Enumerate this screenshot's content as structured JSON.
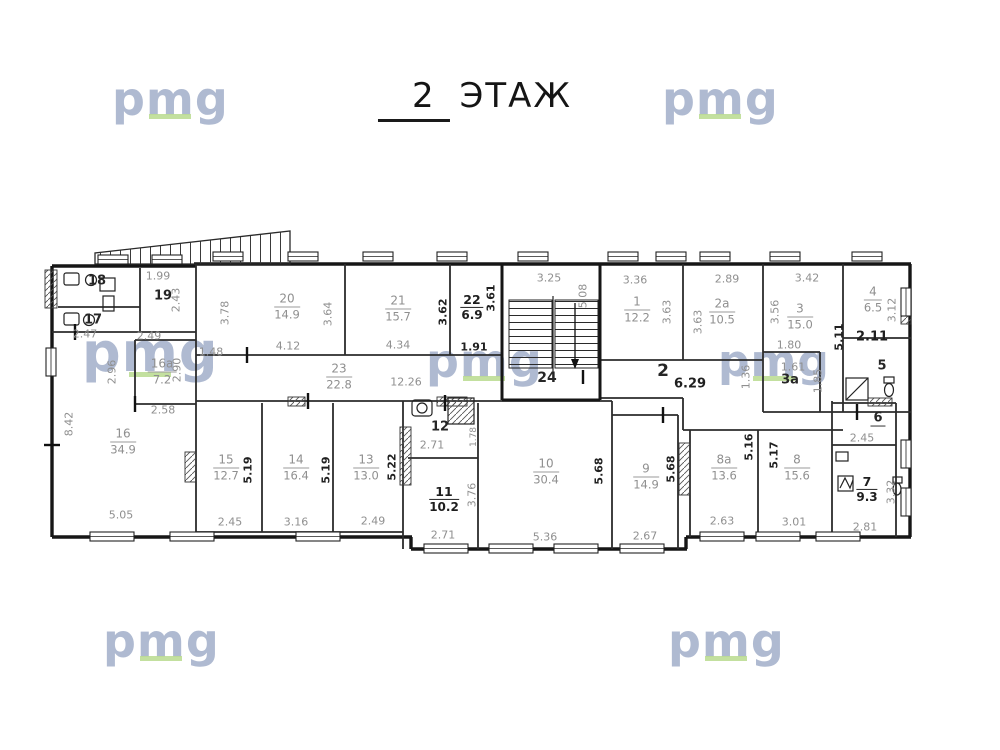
{
  "title": {
    "number": "2",
    "label": "ЭТАЖ"
  },
  "watermark": {
    "text": "pmg",
    "color": "#a9b5ce",
    "underline_color": "#b7d98b"
  },
  "icons": [
    "stairs-icon",
    "fire-escape-stairs-icon",
    "toilet-icon",
    "sink-icon",
    "shower-icon",
    "window-icon"
  ],
  "plan": {
    "floor": "2",
    "labels": [
      {
        "n": "room-20-label",
        "k": "room",
        "num": "20",
        "area": "14.9",
        "x": 287,
        "y": 307
      },
      {
        "n": "room-21-label",
        "k": "room",
        "num": "21",
        "area": "15.7",
        "x": 398,
        "y": 309
      },
      {
        "n": "room-22-label",
        "k": "room-dark",
        "num": "22",
        "area": "6.9",
        "x": 472,
        "y": 308
      },
      {
        "n": "room-1-label",
        "k": "room",
        "num": "1",
        "area": "12.2",
        "x": 637,
        "y": 310
      },
      {
        "n": "room-2a-label",
        "k": "room",
        "num": "2a",
        "area": "10.5",
        "x": 722,
        "y": 312
      },
      {
        "n": "room-3-label",
        "k": "room",
        "num": "3",
        "area": "15.0",
        "x": 800,
        "y": 317
      },
      {
        "n": "room-4-label",
        "k": "room",
        "num": "4",
        "area": "6.5",
        "x": 873,
        "y": 300
      },
      {
        "n": "room-23-label",
        "k": "room",
        "num": "23",
        "area": "22.8",
        "x": 339,
        "y": 377,
        "fs": 10
      },
      {
        "n": "room-16a-label",
        "k": "room",
        "num": "16a",
        "area": "7.2",
        "x": 162,
        "y": 372,
        "fs": 10
      },
      {
        "n": "room-16-label",
        "k": "room",
        "num": "16",
        "area": "34.9",
        "x": 123,
        "y": 442
      },
      {
        "n": "room-15-label",
        "k": "room",
        "num": "15",
        "area": "12.7",
        "x": 226,
        "y": 468
      },
      {
        "n": "room-14-label",
        "k": "room",
        "num": "14",
        "area": "16.4",
        "x": 296,
        "y": 468
      },
      {
        "n": "room-13-label",
        "k": "room",
        "num": "13",
        "area": "13.0",
        "x": 366,
        "y": 468
      },
      {
        "n": "room-11-label",
        "k": "room-dark",
        "num": "11",
        "area": "10.2",
        "x": 444,
        "y": 500
      },
      {
        "n": "room-10-label",
        "k": "room",
        "num": "10",
        "area": "30.4",
        "x": 546,
        "y": 472
      },
      {
        "n": "room-9-label",
        "k": "room",
        "num": "9",
        "area": "14.9",
        "x": 646,
        "y": 477
      },
      {
        "n": "room-8a-label",
        "k": "room",
        "num": "8a",
        "area": "13.6",
        "x": 724,
        "y": 468
      },
      {
        "n": "room-8-label",
        "k": "room",
        "num": "8",
        "area": "15.6",
        "x": 797,
        "y": 468
      },
      {
        "n": "room-7-label",
        "k": "room-dark",
        "num": "7",
        "area": "9.3",
        "x": 867,
        "y": 490
      },
      {
        "n": "room-18-number",
        "k": "num",
        "t": "18",
        "x": 97,
        "y": 282
      },
      {
        "n": "room-17-number",
        "k": "num",
        "t": "17",
        "x": 93,
        "y": 321
      },
      {
        "n": "room-19-number",
        "k": "num",
        "t": "19",
        "x": 163,
        "y": 297
      },
      {
        "n": "room-12-number",
        "k": "num",
        "t": "12",
        "x": 440,
        "y": 428
      },
      {
        "n": "stair-24-number",
        "k": "num",
        "t": "24",
        "x": 547,
        "y": 378,
        "fs": 14
      },
      {
        "n": "room-5-number",
        "k": "num",
        "t": "5",
        "x": 882,
        "y": 367
      },
      {
        "n": "room-3a-number",
        "k": "num",
        "t": "3a",
        "x": 790,
        "y": 381
      },
      {
        "n": "room-6-number",
        "k": "num-ul",
        "t": "6",
        "x": 878,
        "y": 419
      },
      {
        "n": "corridor-2-number",
        "k": "num",
        "t": "2",
        "x": 663,
        "y": 372,
        "fs": 17
      },
      {
        "n": "dim-label",
        "k": "dim",
        "t": "1.99",
        "x": 158,
        "y": 277
      },
      {
        "n": "dim-label",
        "k": "dim",
        "t": "2.43",
        "x": 177,
        "y": 300,
        "r": 1
      },
      {
        "n": "dim-label",
        "k": "dim",
        "t": "2.47",
        "x": 85,
        "y": 335
      },
      {
        "n": "dim-label",
        "k": "dim",
        "t": "2.49",
        "x": 149,
        "y": 337
      },
      {
        "n": "dim-label",
        "k": "dim",
        "t": "2.96",
        "x": 113,
        "y": 372,
        "r": 1
      },
      {
        "n": "dim-label",
        "k": "dim",
        "t": "2.90",
        "x": 178,
        "y": 370,
        "r": 1
      },
      {
        "n": "dim-label",
        "k": "dim",
        "t": "2.58",
        "x": 163,
        "y": 411
      },
      {
        "n": "dim-label",
        "k": "dim",
        "t": "8.42",
        "x": 70,
        "y": 424,
        "r": 1
      },
      {
        "n": "dim-label",
        "k": "dim",
        "t": "5.05",
        "x": 121,
        "y": 516
      },
      {
        "n": "dim-label",
        "k": "dim",
        "t": "1.48",
        "x": 211,
        "y": 353
      },
      {
        "n": "dim-label",
        "k": "dim",
        "t": "3.78",
        "x": 226,
        "y": 313,
        "r": 1
      },
      {
        "n": "dim-label",
        "k": "dim",
        "t": "3.64",
        "x": 329,
        "y": 314,
        "r": 1
      },
      {
        "n": "dim-label",
        "k": "dim",
        "t": "4.12",
        "x": 288,
        "y": 347
      },
      {
        "n": "dim-label",
        "k": "dim-d",
        "t": "3.62",
        "x": 444,
        "y": 312,
        "r": 1
      },
      {
        "n": "dim-label",
        "k": "dim",
        "t": "4.34",
        "x": 398,
        "y": 346
      },
      {
        "n": "dim-label",
        "k": "dim-d",
        "t": "3.61",
        "x": 492,
        "y": 298,
        "r": 1
      },
      {
        "n": "dim-label",
        "k": "dim-d",
        "t": "1.91",
        "x": 474,
        "y": 348
      },
      {
        "n": "dim-label",
        "k": "dim",
        "t": "12.26",
        "x": 406,
        "y": 383
      },
      {
        "n": "dim-label",
        "k": "dim",
        "t": "3.25",
        "x": 549,
        "y": 279
      },
      {
        "n": "dim-label",
        "k": "dim",
        "t": "5.08",
        "x": 584,
        "y": 296,
        "r": 1
      },
      {
        "n": "dim-label",
        "k": "dim",
        "t": "3.36",
        "x": 635,
        "y": 281
      },
      {
        "n": "dim-label",
        "k": "dim",
        "t": "3.63",
        "x": 668,
        "y": 312,
        "r": 1
      },
      {
        "n": "dim-label",
        "k": "dim",
        "t": "2.89",
        "x": 727,
        "y": 280
      },
      {
        "n": "dim-label",
        "k": "dim",
        "t": "3.63",
        "x": 699,
        "y": 322,
        "r": 1
      },
      {
        "n": "dim-label",
        "k": "dim-d",
        "t": "6.29",
        "x": 690,
        "y": 385,
        "fs": 13
      },
      {
        "n": "dim-label",
        "k": "dim",
        "t": "1.36",
        "x": 747,
        "y": 377,
        "r": 1
      },
      {
        "n": "dim-label",
        "k": "dim",
        "t": "3.42",
        "x": 807,
        "y": 279
      },
      {
        "n": "dim-label",
        "k": "dim",
        "t": "3.56",
        "x": 776,
        "y": 312,
        "r": 1
      },
      {
        "n": "dim-label",
        "k": "dim-d",
        "t": "5.11",
        "x": 840,
        "y": 337,
        "r": 1
      },
      {
        "n": "dim-label",
        "k": "dim",
        "t": "3.12",
        "x": 893,
        "y": 310,
        "r": 1
      },
      {
        "n": "dim-label",
        "k": "dim-d",
        "t": "2.11",
        "x": 872,
        "y": 338,
        "fs": 13
      },
      {
        "n": "dim-label",
        "k": "dim",
        "t": "1.80",
        "x": 789,
        "y": 346
      },
      {
        "n": "dim-label",
        "k": "dim",
        "t": "1.61",
        "x": 793,
        "y": 368
      },
      {
        "n": "dim-label",
        "k": "dim",
        "t": "1.85",
        "x": 819,
        "y": 381,
        "r": 1
      },
      {
        "n": "dim-label",
        "k": "dim",
        "t": "2.45",
        "x": 230,
        "y": 523
      },
      {
        "n": "dim-label",
        "k": "dim-d",
        "t": "5.19",
        "x": 249,
        "y": 470,
        "r": 1
      },
      {
        "n": "dim-label",
        "k": "dim",
        "t": "3.16",
        "x": 296,
        "y": 523
      },
      {
        "n": "dim-label",
        "k": "dim-d",
        "t": "5.19",
        "x": 327,
        "y": 470,
        "r": 1
      },
      {
        "n": "dim-label",
        "k": "dim",
        "t": "2.49",
        "x": 373,
        "y": 522
      },
      {
        "n": "dim-label",
        "k": "dim-d",
        "t": "5.22",
        "x": 393,
        "y": 467,
        "r": 1
      },
      {
        "n": "dim-label",
        "k": "dim",
        "t": "2.71",
        "x": 432,
        "y": 446
      },
      {
        "n": "dim-label",
        "k": "dim",
        "t": "1.78",
        "x": 474,
        "y": 437,
        "r": 1,
        "fs": 9
      },
      {
        "n": "dim-label",
        "k": "dim",
        "t": "3.76",
        "x": 473,
        "y": 495,
        "r": 1
      },
      {
        "n": "dim-label",
        "k": "dim",
        "t": "2.71",
        "x": 443,
        "y": 536
      },
      {
        "n": "dim-label",
        "k": "dim",
        "t": "5.36",
        "x": 545,
        "y": 538
      },
      {
        "n": "dim-label",
        "k": "dim-d",
        "t": "5.68",
        "x": 600,
        "y": 471,
        "r": 1
      },
      {
        "n": "dim-label",
        "k": "dim-d",
        "t": "5.68",
        "x": 672,
        "y": 469,
        "r": 1
      },
      {
        "n": "dim-label",
        "k": "dim",
        "t": "2.67",
        "x": 645,
        "y": 537
      },
      {
        "n": "dim-label",
        "k": "dim-d",
        "t": "5.16",
        "x": 750,
        "y": 447,
        "r": 1
      },
      {
        "n": "dim-label",
        "k": "dim",
        "t": "2.63",
        "x": 722,
        "y": 522
      },
      {
        "n": "dim-label",
        "k": "dim-d",
        "t": "5.17",
        "x": 775,
        "y": 455,
        "r": 1
      },
      {
        "n": "dim-label",
        "k": "dim",
        "t": "3.01",
        "x": 794,
        "y": 523
      },
      {
        "n": "dim-label",
        "k": "dim",
        "t": "3.32",
        "x": 892,
        "y": 492,
        "r": 1
      },
      {
        "n": "dim-label",
        "k": "dim",
        "t": "2.81",
        "x": 865,
        "y": 528
      },
      {
        "n": "dim-label",
        "k": "dim",
        "t": "2.45",
        "x": 862,
        "y": 439
      }
    ]
  }
}
